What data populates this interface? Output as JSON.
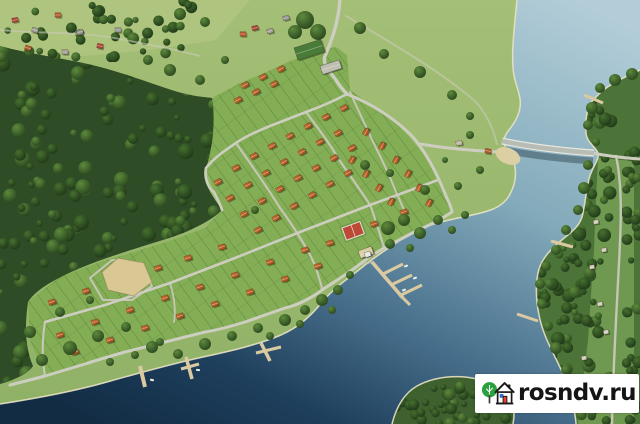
{
  "watermark": {
    "text": "rosndv.ru",
    "logo": "tree-and-house-icon"
  },
  "palette": {
    "water_top": "#b2cdd8",
    "water_mid": "#84abbb",
    "water_deep": "#122c44",
    "meadow": "#a4bf76",
    "meadow_dark": "#90b266",
    "field_light": "#b3c883",
    "dev_green": "#84ae55",
    "forest_base": "#2e4c26",
    "east_base": "#4c7438",
    "clearing": "#76a055",
    "road": "#cdcec0",
    "road_minor": "#c5c6b5",
    "track": "#c9c9b8",
    "shore_edge": "#e9e2c6",
    "roof_light": "#c96f33",
    "roof_dark": "#9c4a20",
    "pier": "#dbc9a1",
    "bridge_deck": "#b7bcb4",
    "bridge_edge": "#e6e8e0",
    "tennis": "#bc4a36",
    "sand": "#d9c894",
    "beach": "#dccfa4",
    "entrance_roof": "#4a7c39",
    "parking": "#bfbfb2",
    "village_roofs": [
      "#a8433a",
      "#9aa0a3",
      "#b0562f",
      "#8f9aa0"
    ],
    "east_house": "#ccd2cc",
    "boat": "#ecefe9"
  },
  "landforms": {
    "west_land": "M517,0 C514,30 510,62 515,80 C519,94 523,102 518,115 C513,128 505,132 504,140 C503,149 512,153 514,162 C517,173 516,184 509,196 C501,209 487,212 463,217 C438,222 419,227 399,241 C381,253 375,257 365,265 C349,278 335,287 323,301 C311,316 299,327 281,335 C257,345 231,351 203,357 C171,364 139,373 107,382 C75,391 39,398 0,404 L0,0 Z",
    "east_land": "M640,70 C621,79 607,85 596,97 C587,105 585,119 586,133 C587,143 596,147 598,153 C600,159 592,167 589,179 C586,193 585,203 583,213 C581,225 573,231 563,239 C551,249 543,257 539,269 C535,283 536,301 539,315 C542,331 549,345 557,361 C565,377 571,393 574,409 C575,417 576,420 576,424 L640,424 Z",
    "peninsula": "M392,424 C396,408 403,394 417,386 C433,377 457,374 477,379 C495,383 507,392 512,404 C515,412 514,418 513,424 Z",
    "forest_west": "M0,46 C30,54 62,58 92,65 C122,72 152,84 178,92 C196,97 206,97 212,98 C216,122 212,150 206,168 C202,186 216,200 222,210 C210,222 188,232 166,239 C138,248 106,257 78,269 C50,281 34,292 28,302 C24,330 26,350 33,366 C28,374 14,380 0,384 Z",
    "dev_area": "M212,98 L238,84 L262,74 L288,62 L312,52 L336,47 L347,55 L350,90 L370,104 L392,118 L412,140 L430,162 L444,186 L452,212 L418,230 L384,248 L360,264 L322,290 L285,308 L245,322 L205,332 L165,342 L125,352 L85,364 L45,376 L30,340 L28,302 L60,277 L100,262 L140,250 L172,240 L205,228 L222,210 L214,192 L206,168 L210,138 Z",
    "field_top": "M0,0 L250,0 L216,40 L150,50 L60,58 L0,55 Z",
    "clearing_east": "M598,158 L634,161 L634,424 L578,424 L588,340 L594,250 L596,200 Z"
  },
  "shorelines": {
    "west": "M517,0 C514,30 510,62 515,80 C519,94 523,102 518,115 C513,128 505,132 504,140 C503,149 512,153 514,162 C517,173 516,184 509,196 C501,209 487,212 463,217 C438,222 419,227 399,241 C381,253 375,257 365,265 C349,278 335,287 323,301 C311,316 299,327 281,335 C257,345 231,351 203,357 C171,364 139,373 107,382 C75,391 39,398 0,404",
    "east": "M640,70 C621,79 607,85 596,97 C587,105 585,119 586,133 C587,143 596,147 598,153 C600,159 592,167 589,179 C586,193 585,203 583,213 C581,225 573,231 563,239 C551,249 543,257 539,269 C535,283 536,301 539,315 C542,331 549,345 557,361 C565,377 571,393 574,409 C575,417 576,420 576,424",
    "peninsula": "M392,424 C396,408 403,394 417,386 C433,377 457,374 477,379 C495,383 507,392 512,404 C515,412 514,418 513,424"
  },
  "roads": {
    "main": [
      {
        "d": "M340,0 C338,26 330,44 325,56 C322,64 330,72 336,80 C340,87 344,91 347,94",
        "w": 3.4
      },
      {
        "d": "M347,94 C372,104 394,118 412,136 C426,152 438,176 446,196 C450,205 452,209 452,212",
        "w": 3
      },
      {
        "d": "M452,212 C440,220 428,226 418,230 L384,248 C374,254 366,259 360,264 C346,275 332,283 322,290 C310,299 298,305 285,308 L245,322 C232,326 218,330 205,332 L125,352 C111,356 97,360 85,364 L45,376 C34,379 22,382 10,385",
        "w": 3
      },
      {
        "d": "M420,144 C438,147 456,149 470,150 C482,151 494,152 503,152",
        "w": 3
      },
      {
        "d": "M347,94 C334,101 320,107 306,112 L270,126 C258,131 246,136 236,143 C224,151 214,158 206,168 C204,178 208,188 214,192 C218,200 221,206 222,210",
        "w": 2.6
      },
      {
        "d": "M438,180 L370,205 L300,232 L235,258 L170,283 L105,305 L45,322",
        "w": 2.6
      },
      {
        "d": "M592,153 C608,156 624,158 640,159",
        "w": 3
      }
    ],
    "minor": [
      {
        "d": "M236,143 C252,166 268,188 280,208 C292,224 310,252 316,268 C319,278 322,286 322,290",
        "w": 2.2
      },
      {
        "d": "M306,112 C318,128 330,144 338,158 C350,176 362,192 370,205 C376,220 380,234 384,248",
        "w": 2.2
      },
      {
        "d": "M350,92 C360,114 370,136 380,156 C388,172 396,192 404,210",
        "w": 2
      },
      {
        "d": "M45,322 C42,340 42,358 45,376",
        "w": 2.2
      },
      {
        "d": "M103,300 L90,278 L112,260 L142,263 L152,286 L132,300 Z",
        "w": 2
      },
      {
        "d": "M616,156 C624,192 620,242 618,282 C616,322 613,372 612,424",
        "w": 2.4
      },
      {
        "d": "M170,283 C174,296 176,310 174,322",
        "w": 1.8
      }
    ],
    "tracks": [
      {
        "d": "M346,16 C390,42 442,72 476,102 C488,116 494,131 497,144",
        "w": 2
      },
      {
        "d": "M0,30 C40,34 80,31 120,39 C150,45 178,50 200,56",
        "w": 1.8
      },
      {
        "d": "M360,264 C364,264 368,263 372,262",
        "w": 2
      }
    ]
  },
  "bridge": {
    "shadow": "M504,147 C535,153 565,156 593,158",
    "deck": "M502,141 C535,148 566,151 594,153"
  },
  "piers": [
    {
      "d": "M140,366 L145,387",
      "w": 4
    },
    {
      "d": "M186,357 L192,379",
      "w": 3.5
    },
    {
      "d": "M181,369 L199,364",
      "w": 3
    },
    {
      "d": "M261,343 L270,361",
      "w": 3.5
    },
    {
      "d": "M256,353 L281,347",
      "w": 3
    },
    {
      "d": "M584,95 L603,103",
      "w": 3
    },
    {
      "d": "M551,241 L573,247",
      "w": 3
    },
    {
      "d": "M517,314 L538,321",
      "w": 3
    }
  ],
  "marina": {
    "walks": [
      {
        "d": "M372,262 L403,298",
        "w": 3.6
      },
      {
        "d": "M383,274 L403,264",
        "w": 3
      },
      {
        "d": "M391,285 L412,275",
        "w": 3
      },
      {
        "d": "M399,296 L422,285",
        "w": 3
      },
      {
        "d": "M403,298 L410,305",
        "w": 3
      }
    ],
    "base": {
      "x": 358,
      "y": 251,
      "w": 14,
      "h": 8,
      "rot": -20
    },
    "house": {
      "x": 364,
      "y": 253,
      "w": 6,
      "h": 5,
      "rot": -20
    }
  },
  "amenities": {
    "tennis": {
      "x": 342,
      "y": 228,
      "w": 19,
      "h": 13,
      "rot": -20
    },
    "playground": {
      "path": "M102,272 L118,258 L144,263 L152,282 L134,296 L108,290 Z"
    },
    "beach": {
      "cx": 508,
      "cy": 156,
      "rx": 13,
      "ry": 8,
      "rot": 24
    },
    "entrance": {
      "x": 294,
      "y": 48,
      "w": 28,
      "h": 13,
      "rot": -18
    },
    "parking": {
      "x": 320,
      "y": 66,
      "w": 20,
      "h": 9,
      "rot": -18
    }
  },
  "houses": {
    "dev": [
      {
        "rot": -28,
        "pts": [
          [
            245,
            85
          ],
          [
            263,
            77
          ],
          [
            281,
            69
          ],
          [
            238,
            100
          ],
          [
            256,
            92
          ],
          [
            274,
            84
          ],
          [
            218,
            182
          ],
          [
            236,
            168
          ],
          [
            254,
            156
          ],
          [
            272,
            146
          ],
          [
            290,
            136
          ],
          [
            308,
            126
          ],
          [
            326,
            117
          ],
          [
            344,
            108
          ],
          [
            230,
            198
          ],
          [
            248,
            185
          ],
          [
            266,
            173
          ],
          [
            284,
            162
          ],
          [
            302,
            152
          ],
          [
            320,
            142
          ],
          [
            338,
            133
          ],
          [
            244,
            214
          ],
          [
            262,
            201
          ],
          [
            280,
            189
          ],
          [
            298,
            178
          ],
          [
            316,
            168
          ],
          [
            334,
            158
          ],
          [
            352,
            148
          ],
          [
            258,
            230
          ],
          [
            276,
            218
          ],
          [
            294,
            206
          ],
          [
            312,
            195
          ],
          [
            330,
            184
          ],
          [
            348,
            173
          ]
        ]
      },
      {
        "rot": -62,
        "pts": [
          [
            366,
            132
          ],
          [
            382,
            146
          ],
          [
            396,
            160
          ],
          [
            408,
            174
          ],
          [
            419,
            188
          ],
          [
            429,
            203
          ],
          [
            352,
            160
          ],
          [
            366,
            174
          ],
          [
            379,
            188
          ],
          [
            391,
            202
          ]
        ]
      },
      {
        "rot": -18,
        "pts": [
          [
            52,
            302
          ],
          [
            86,
            291
          ],
          [
            158,
            268
          ],
          [
            188,
            258
          ],
          [
            222,
            247
          ],
          [
            60,
            335
          ],
          [
            95,
            322
          ],
          [
            130,
            310
          ],
          [
            165,
            298
          ],
          [
            200,
            287
          ],
          [
            235,
            275
          ],
          [
            270,
            262
          ],
          [
            305,
            250
          ],
          [
            330,
            243
          ],
          [
            374,
            224
          ],
          [
            404,
            212
          ],
          [
            75,
            352
          ],
          [
            110,
            340
          ],
          [
            145,
            328
          ],
          [
            180,
            316
          ],
          [
            215,
            304
          ],
          [
            250,
            292
          ],
          [
            285,
            279
          ],
          [
            318,
            266
          ]
        ]
      }
    ],
    "village": [
      [
        15,
        20,
        -10
      ],
      [
        35,
        30,
        15
      ],
      [
        58,
        15,
        0
      ],
      [
        80,
        32,
        -15
      ],
      [
        100,
        46,
        10
      ],
      [
        65,
        52,
        0
      ],
      [
        28,
        48,
        20
      ],
      [
        118,
        30,
        0
      ],
      [
        255,
        28,
        -15
      ],
      [
        270,
        31,
        -15
      ],
      [
        243,
        34,
        0
      ],
      [
        286,
        18,
        -15
      ]
    ],
    "east_bank": [
      [
        596,
        222
      ],
      [
        604,
        250
      ],
      [
        592,
        267
      ],
      [
        600,
        304
      ],
      [
        584,
        358
      ],
      [
        606,
        332
      ],
      [
        590,
        384
      ]
    ],
    "meadow": [
      [
        459,
        143
      ],
      [
        488,
        151
      ]
    ]
  },
  "boats": [
    [
      406,
      266,
      -20
    ],
    [
      415,
      278,
      -20
    ],
    [
      404,
      290,
      -20
    ],
    [
      152,
      380,
      10
    ],
    [
      198,
      370,
      5
    ]
  ],
  "trees": {
    "meadow": [
      [
        360,
        28,
        6
      ],
      [
        384,
        54,
        5
      ],
      [
        420,
        72,
        6
      ],
      [
        452,
        95,
        5
      ],
      [
        470,
        116,
        4
      ],
      [
        365,
        165,
        5
      ],
      [
        390,
        173,
        4
      ],
      [
        425,
        190,
        5
      ],
      [
        458,
        186,
        4
      ],
      [
        480,
        170,
        4
      ],
      [
        445,
        160,
        3
      ],
      [
        305,
        20,
        9
      ],
      [
        318,
        32,
        8
      ],
      [
        295,
        32,
        7
      ],
      [
        205,
        22,
        5
      ],
      [
        180,
        14,
        6
      ],
      [
        225,
        60,
        4
      ],
      [
        200,
        80,
        5
      ],
      [
        170,
        70,
        6
      ],
      [
        148,
        60,
        5
      ],
      [
        255,
        210,
        4
      ],
      [
        470,
        135,
        4
      ]
    ],
    "shore": [
      [
        20,
        352,
        7
      ],
      [
        42,
        360,
        6
      ],
      [
        70,
        348,
        7
      ],
      [
        98,
        336,
        6
      ],
      [
        126,
        327,
        5
      ],
      [
        152,
        347,
        6
      ],
      [
        178,
        354,
        5
      ],
      [
        205,
        344,
        6
      ],
      [
        232,
        336,
        5
      ],
      [
        258,
        328,
        5
      ],
      [
        285,
        320,
        6
      ],
      [
        305,
        310,
        5
      ],
      [
        322,
        300,
        6
      ],
      [
        338,
        290,
        5
      ],
      [
        60,
        312,
        5
      ],
      [
        30,
        332,
        6
      ],
      [
        90,
        300,
        4
      ],
      [
        388,
        228,
        7
      ],
      [
        404,
        220,
        6
      ],
      [
        420,
        233,
        6
      ],
      [
        438,
        220,
        5
      ],
      [
        452,
        230,
        4
      ],
      [
        300,
        324,
        4
      ],
      [
        270,
        336,
        4
      ],
      [
        160,
        342,
        4
      ],
      [
        110,
        362,
        4
      ],
      [
        135,
        355,
        4
      ],
      [
        390,
        244,
        5
      ],
      [
        410,
        248,
        4
      ],
      [
        465,
        215,
        4
      ],
      [
        350,
        275,
        4
      ],
      [
        332,
        310,
        4
      ]
    ],
    "east_edge": [
      [
        592,
        108,
        6
      ],
      [
        588,
        125,
        5
      ],
      [
        596,
        142,
        4
      ],
      [
        588,
        165,
        5
      ],
      [
        584,
        188,
        6
      ],
      [
        578,
        210,
        5
      ],
      [
        566,
        230,
        5
      ],
      [
        556,
        250,
        5
      ],
      [
        546,
        266,
        5
      ],
      [
        540,
        284,
        5
      ],
      [
        542,
        304,
        5
      ],
      [
        548,
        326,
        5
      ],
      [
        556,
        348,
        6
      ],
      [
        566,
        370,
        5
      ],
      [
        572,
        392,
        5
      ],
      [
        600,
        88,
        5
      ],
      [
        615,
        80,
        6
      ],
      [
        632,
        74,
        6
      ],
      [
        608,
        170,
        4
      ],
      [
        604,
        200,
        4
      ],
      [
        580,
        400,
        5
      ],
      [
        592,
        412,
        5
      ]
    ]
  },
  "forest_fill": {
    "west": {
      "x0": 0,
      "y0": 42,
      "x1": 232,
      "y1": 392,
      "count": 240,
      "rmin": 3,
      "rmax": 8,
      "seed": 7,
      "clip": "forest_west"
    },
    "east": {
      "x0": 534,
      "y0": 72,
      "x1": 612,
      "y1": 424,
      "count": 150,
      "rmin": 3,
      "rmax": 7,
      "seed": 11,
      "clip": "east_land"
    },
    "east_far": {
      "x0": 626,
      "y0": 150,
      "x1": 640,
      "y1": 424,
      "count": 40,
      "rmin": 3,
      "rmax": 6,
      "seed": 5,
      "clip": "east_land"
    },
    "peninsula": {
      "x0": 394,
      "y0": 376,
      "x1": 514,
      "y1": 424,
      "count": 60,
      "rmin": 3,
      "rmax": 6,
      "seed": 3,
      "clip": "peninsula"
    },
    "village": {
      "x0": 0,
      "y0": 0,
      "x1": 200,
      "y1": 60,
      "count": 40,
      "rmin": 3,
      "rmax": 6,
      "seed": 9,
      "clip": null
    }
  }
}
